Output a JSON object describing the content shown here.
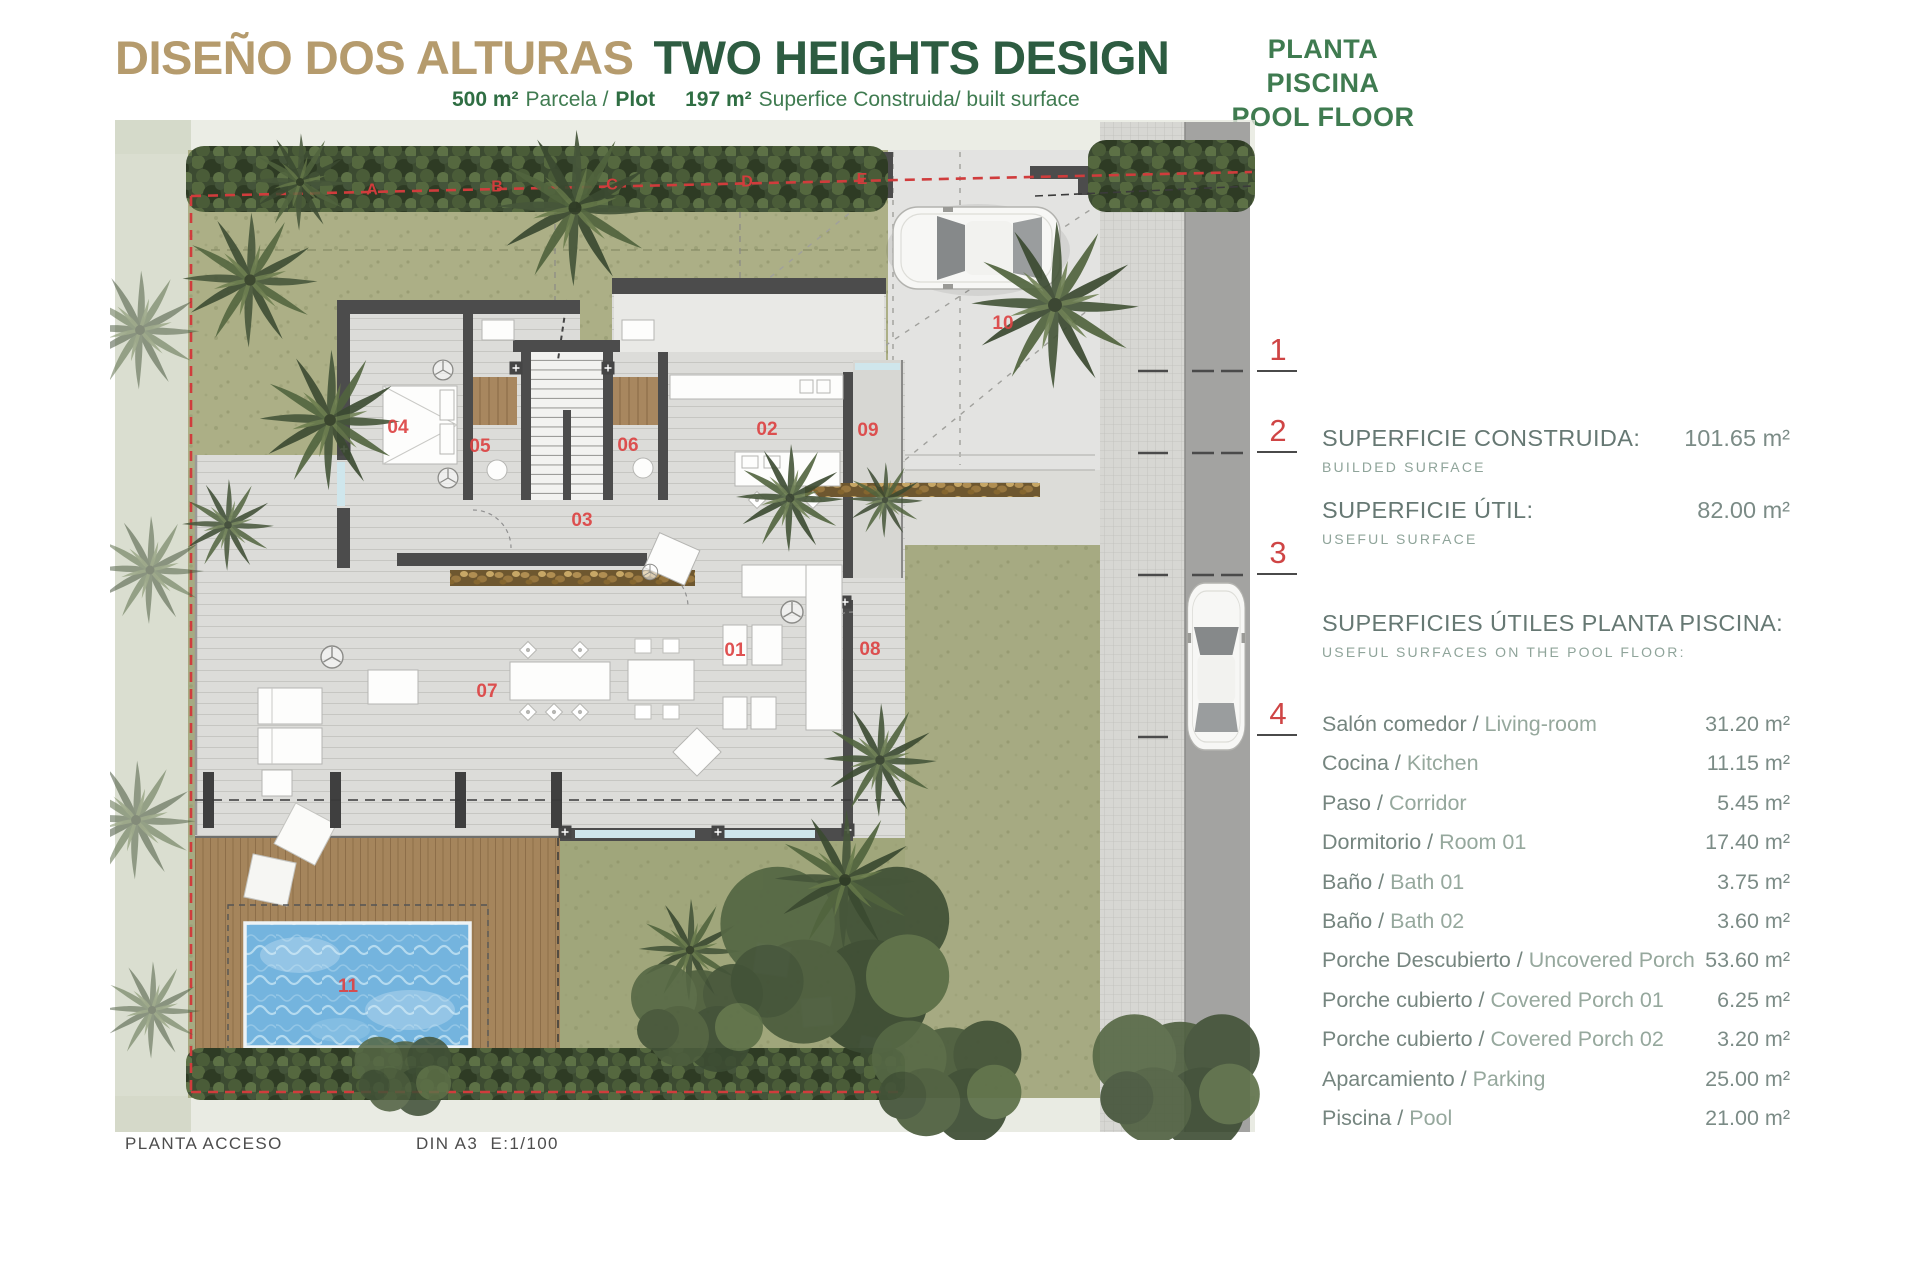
{
  "header": {
    "title_es": "DISEÑO DOS ALTURAS",
    "title_en": "TWO HEIGHTS DESIGN",
    "subtitle_parts": [
      {
        "text": "500 m²",
        "bold": true,
        "gap": false
      },
      {
        "text": "Parcela /",
        "bold": false,
        "gap": false
      },
      {
        "text": "Plot",
        "bold": true,
        "gap": false
      },
      {
        "text": "197 m²",
        "bold": true,
        "gap": true
      },
      {
        "text": "Superfice Construida/ built surface",
        "bold": false,
        "gap": false
      }
    ],
    "floor_label_es": "PLANTA PISCINA",
    "floor_label_en": "POOL FLOOR"
  },
  "panel": {
    "unit": "m²",
    "built": {
      "label": "SUPERFICIE CONSTRUIDA:",
      "sub": "BUILDED SURFACE",
      "value": "101.65"
    },
    "useful": {
      "label": "SUPERFICIE ÚTIL:",
      "sub": "USEFUL SURFACE",
      "value": "82.00"
    },
    "list_header": {
      "label": "SUPERFICIES ÚTILES PLANTA PISCINA:",
      "sub": "USEFUL SURFACES ON THE POOL FLOOR:"
    },
    "rows": [
      {
        "es": "Salón comedor",
        "en": "Living-room",
        "value": "31.20"
      },
      {
        "es": "Cocina",
        "en": "Kitchen",
        "value": "11.15"
      },
      {
        "es": "Paso",
        "en": "Corridor",
        "value": "5.45"
      },
      {
        "es": "Dormitorio",
        "en": "Room 01",
        "value": "17.40"
      },
      {
        "es": "Baño",
        "en": "Bath 01",
        "value": "3.75"
      },
      {
        "es": "Baño",
        "en": "Bath 02",
        "value": "3.60"
      },
      {
        "es": "Porche Descubierto",
        "en": "Uncovered Porch",
        "value": "53.60"
      },
      {
        "es": "Porche cubierto",
        "en": "Covered Porch 01",
        "value": "6.25"
      },
      {
        "es": "Porche cubierto",
        "en": "Covered Porch 02",
        "value": "3.20"
      },
      {
        "es": "Aparcamiento",
        "en": "Parking",
        "value": "25.00"
      },
      {
        "es": "Piscina",
        "en": "Pool",
        "value": "21.00"
      }
    ],
    "indices": [
      "1",
      "2",
      "3",
      "4"
    ]
  },
  "plan": {
    "room_labels": [
      {
        "n": "01",
        "x": 735,
        "y": 656
      },
      {
        "n": "02",
        "x": 767,
        "y": 435
      },
      {
        "n": "03",
        "x": 582,
        "y": 526
      },
      {
        "n": "04",
        "x": 398,
        "y": 433
      },
      {
        "n": "05",
        "x": 480,
        "y": 452
      },
      {
        "n": "06",
        "x": 628,
        "y": 451
      },
      {
        "n": "07",
        "x": 487,
        "y": 697
      },
      {
        "n": "08",
        "x": 870,
        "y": 655
      },
      {
        "n": "09",
        "x": 868,
        "y": 436
      },
      {
        "n": "10",
        "x": 1003,
        "y": 329
      },
      {
        "n": "11",
        "x": 348,
        "y": 992
      }
    ],
    "boundary_letters": [
      {
        "t": "A",
        "x": 372
      },
      {
        "t": "B",
        "x": 497
      },
      {
        "t": "C",
        "x": 612
      },
      {
        "t": "D",
        "x": 747
      },
      {
        "t": "E",
        "x": 862
      }
    ],
    "footer_left": "PLANTA ACCESO",
    "footer_right": "DIN A3  E:1/100"
  },
  "colors": {
    "title_tan": "#b59b6d",
    "title_green": "#2d5c41",
    "subtitle_green": "#3f7b50",
    "panel_gray": "#667873",
    "red_labels": "#cf4545",
    "pool_blue": "#74b4de",
    "deck_brown": "#a5855c",
    "garden_olive": "#a6aa82"
  }
}
